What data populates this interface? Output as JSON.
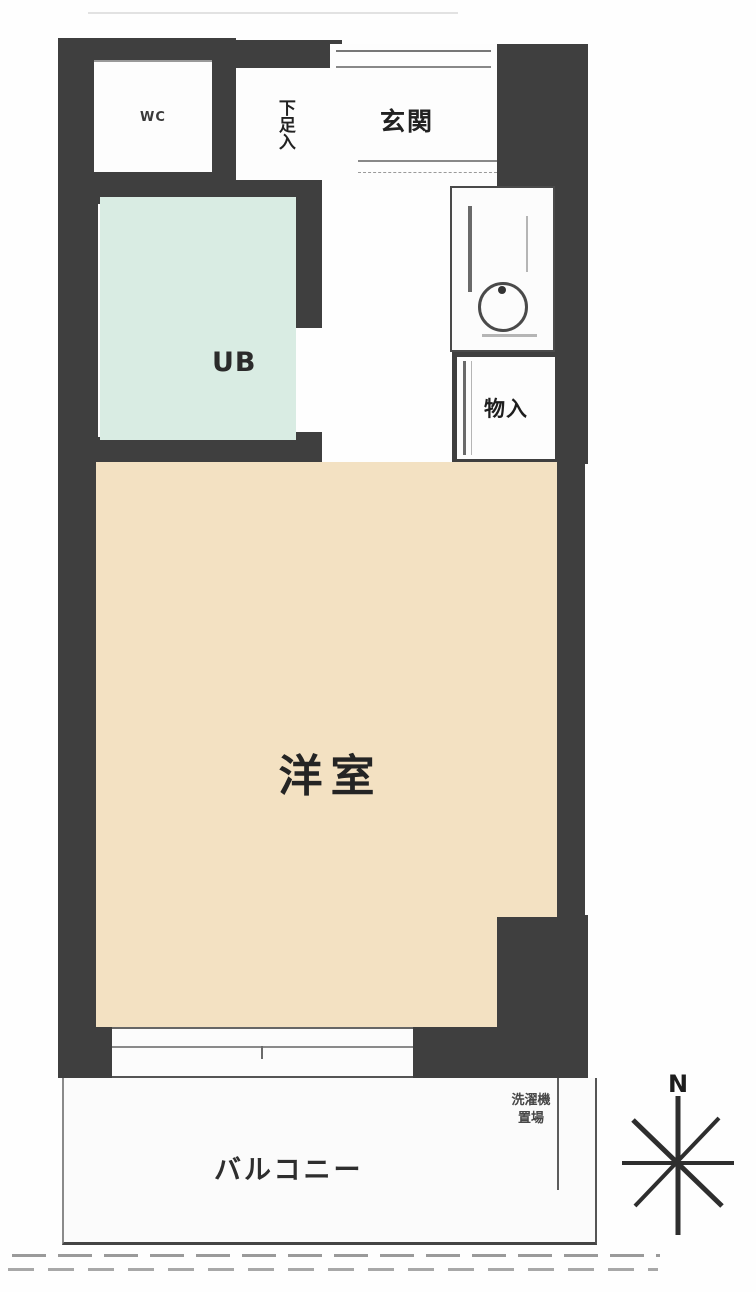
{
  "floorplan": {
    "title": "apartment-floor-plan",
    "rooms": {
      "wc": {
        "label": "WC"
      },
      "shoe_storage": {
        "label": "下足入"
      },
      "entrance": {
        "label": "玄関"
      },
      "storage": {
        "label": "物入"
      },
      "unit_bath": {
        "label": "UB"
      },
      "western_room": {
        "label": "洋室"
      },
      "balcony": {
        "label": "バルコニー"
      },
      "washing_machine_place": {
        "line1": "洗濯機",
        "line2": "置場"
      }
    },
    "compass": {
      "north_label": "N"
    },
    "colors": {
      "wall": "#3f3f3f",
      "unit_bath_fill": "#d9ece3",
      "western_room_fill": "#f3e1c2",
      "balcony_fill": "#fbfbfb",
      "kitchen_fixture_line": "#555555"
    }
  }
}
